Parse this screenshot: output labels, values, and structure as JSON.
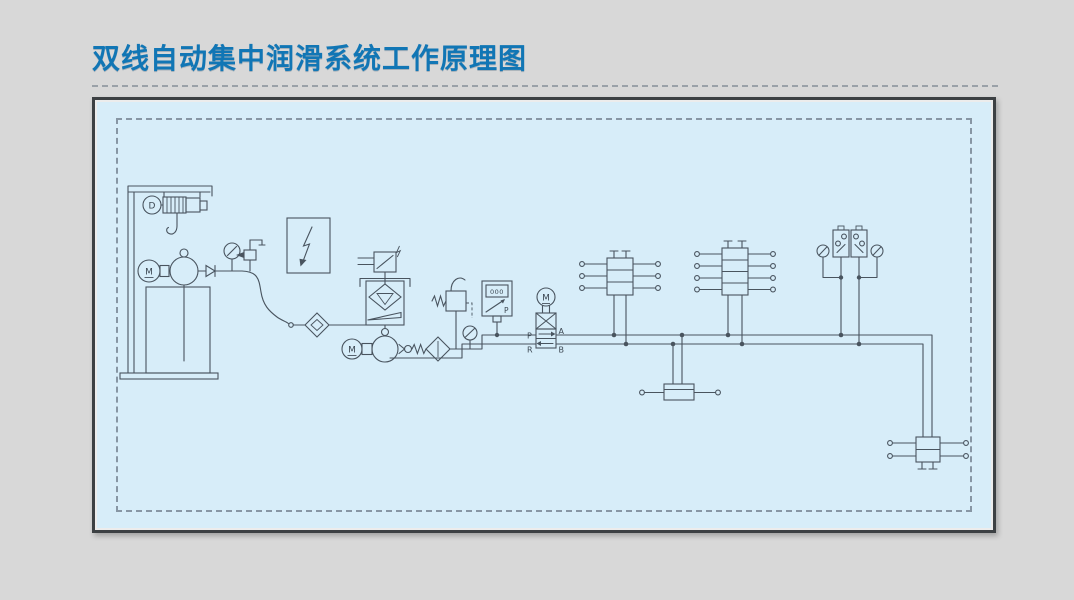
{
  "page": {
    "title": "双线自动集中润滑系统工作原理图"
  },
  "diagram": {
    "labels": {
      "hoist_motor": "D",
      "fill_pump_motor": "M",
      "main_pump_motor": "M",
      "valve_motor": "M",
      "port_p": "P",
      "port_a": "A",
      "port_r": "R",
      "port_b": "B",
      "pressure_display": "000",
      "transmitter_p": "P"
    },
    "colors": {
      "title": "#1176b5",
      "panel_bg": "#d7edf9",
      "line": "#49545f",
      "page_bg": "#d8d8d8"
    },
    "components": [
      {
        "name": "electric-hoist"
      },
      {
        "name": "grease-barrel"
      },
      {
        "name": "barrel-pump-motor"
      },
      {
        "name": "barrel-pump"
      },
      {
        "name": "fill-pressure-gauge"
      },
      {
        "name": "fill-coupler"
      },
      {
        "name": "flexible-hose"
      },
      {
        "name": "fill-filter"
      },
      {
        "name": "electric-control-cabinet"
      },
      {
        "name": "grease-reservoir"
      },
      {
        "name": "level-switch"
      },
      {
        "name": "main-pump-motor"
      },
      {
        "name": "main-pump"
      },
      {
        "name": "check-valve"
      },
      {
        "name": "pressure-filter"
      },
      {
        "name": "relief-valve"
      },
      {
        "name": "pressure-gauge"
      },
      {
        "name": "pressure-transmitter"
      },
      {
        "name": "motorized-reversing-valve"
      },
      {
        "name": "dual-line-distributor-1"
      },
      {
        "name": "dual-line-distributor-2"
      },
      {
        "name": "dual-line-distributor-3"
      },
      {
        "name": "dual-line-distributor-4"
      },
      {
        "name": "end-line-pressure-switch-a"
      },
      {
        "name": "end-line-pressure-switch-b"
      },
      {
        "name": "end-line-gauge-a"
      },
      {
        "name": "end-line-gauge-b"
      },
      {
        "name": "main-line-a"
      },
      {
        "name": "main-line-b"
      }
    ]
  }
}
